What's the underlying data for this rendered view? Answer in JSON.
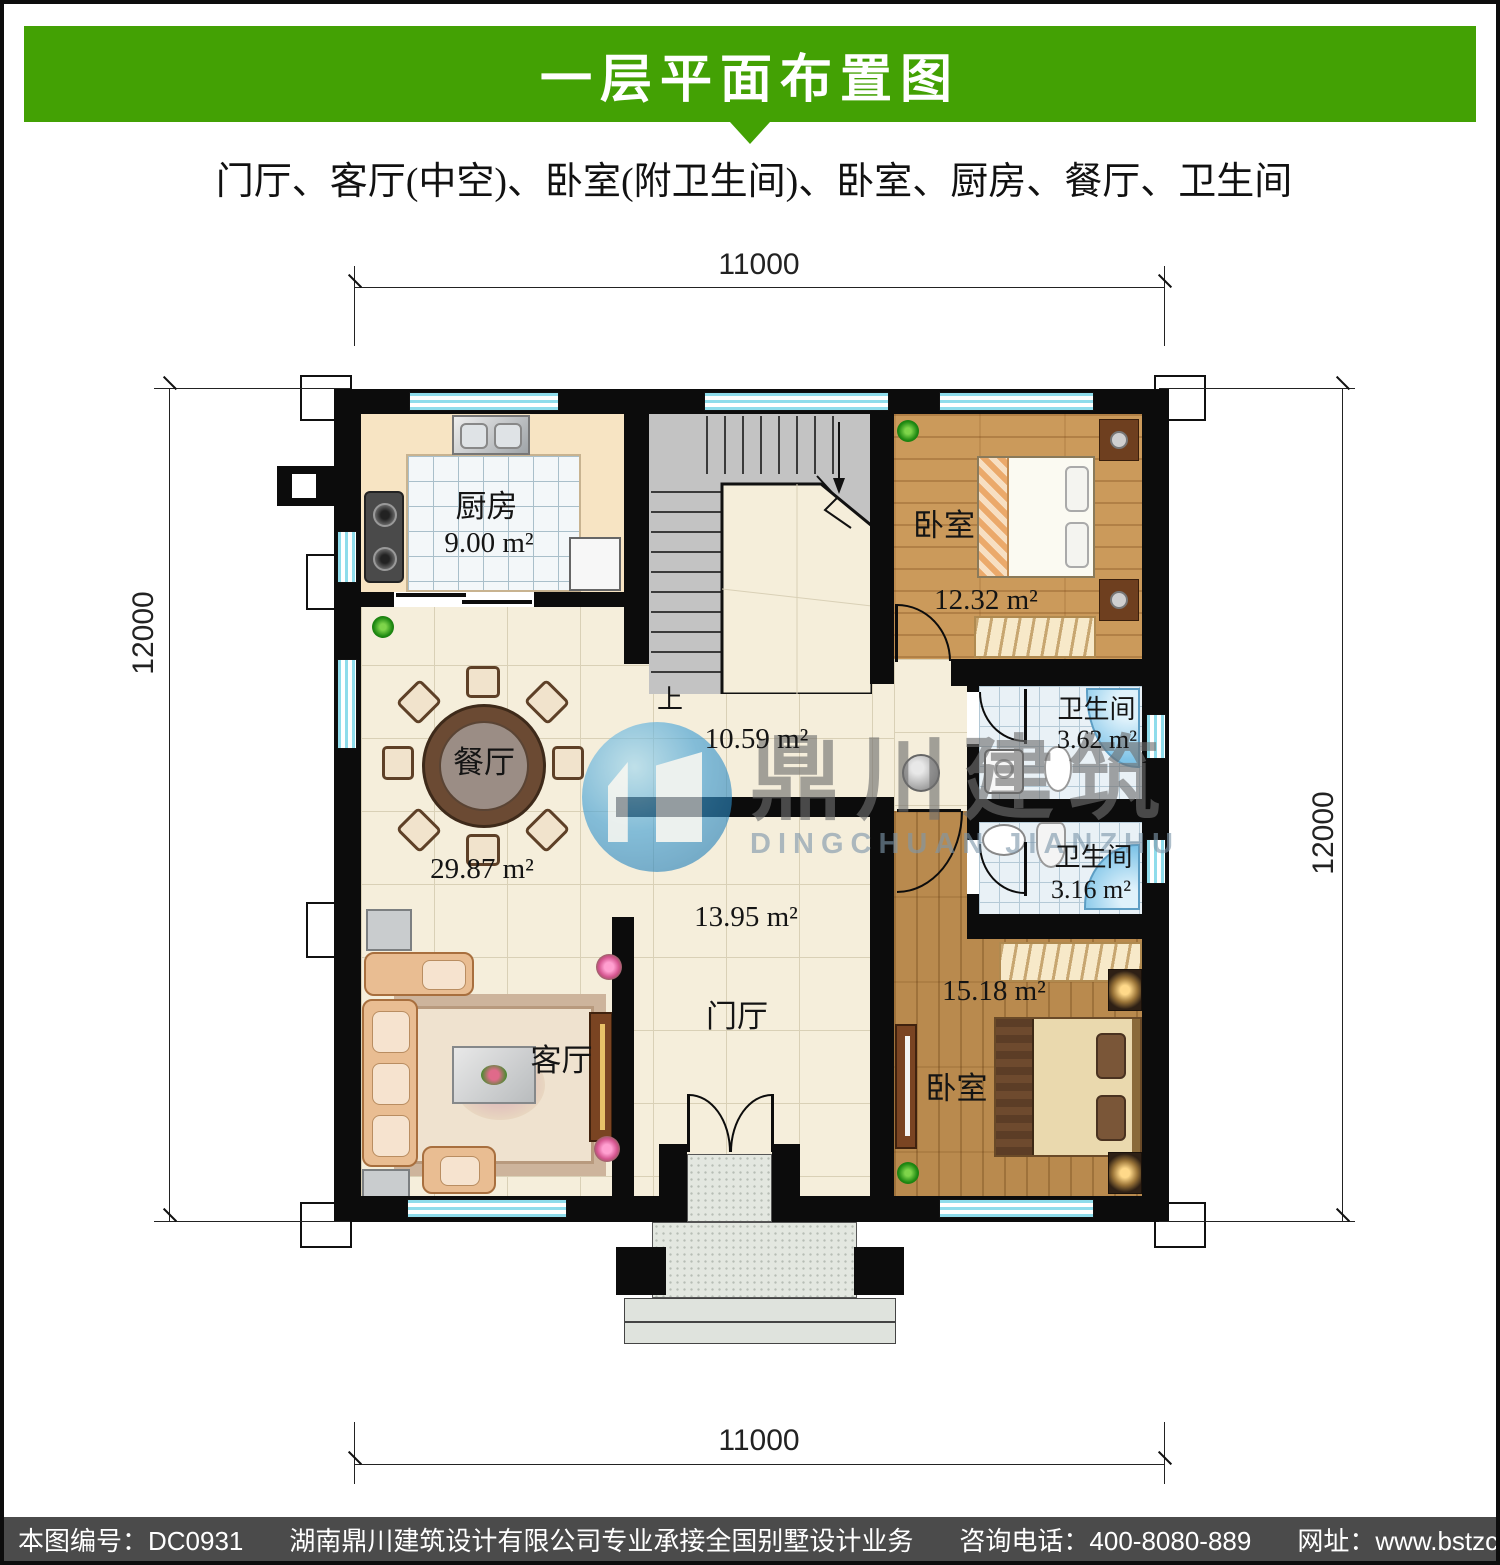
{
  "header": {
    "title": "一层平面布置图",
    "subtitle": "门厅、客厅(中空)、卧室(附卫生间)、卧室、厨房、餐厅、卫生间"
  },
  "dimensions": {
    "top": "11000",
    "bottom": "11000",
    "left": "12000",
    "right": "12000"
  },
  "rooms": {
    "kitchen": {
      "name": "厨房",
      "area": "9.00 m²"
    },
    "bedroom_top": {
      "name": "卧室",
      "area": "12.32 m²"
    },
    "bath_top": {
      "name": "卫生间",
      "area": "3.62 m²"
    },
    "bath_bottom": {
      "name": "卫生间",
      "area": "3.16 m²"
    },
    "bedroom_bottom": {
      "name": "卧室",
      "area": "15.18 m²"
    },
    "dining": {
      "name": "餐厅"
    },
    "living": {
      "name": "客厅",
      "area": "29.87 m²"
    },
    "hall": {
      "name": "门厅",
      "area": "13.95 m²"
    },
    "stair_hall": {
      "area": "10.59 m²"
    },
    "stairs": {
      "up_label": "上"
    }
  },
  "watermark": {
    "name": "鼎川建筑",
    "latin": "DINGCHUAN JIANZHU"
  },
  "footer": {
    "sheet_no": "本图编号：DC0931",
    "company": "湖南鼎川建筑设计有限公司专业承接全国别墅设计业务",
    "phone": "咨询电话：400-8080-889",
    "website": "网址：www.bstzcs.com"
  },
  "colors": {
    "banner_green": "#43a104",
    "footer_gray": "#4b4b4b",
    "window_blue": "#8edceb",
    "wall_black": "#0c0c0c"
  }
}
